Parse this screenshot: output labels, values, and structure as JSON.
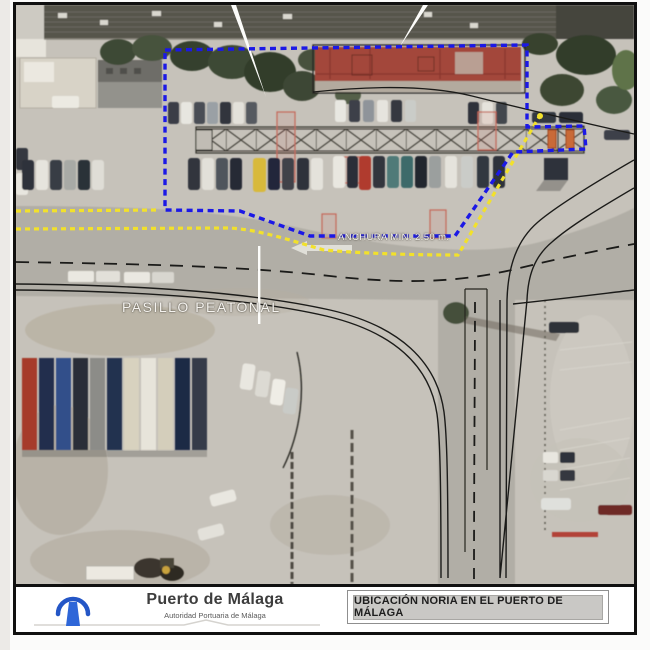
{
  "map": {
    "labels": {
      "pasillo": "PASILLO PEATONAL",
      "anchura": "ANCHURA MIN. 2.50 m."
    },
    "colors": {
      "site_boundary": "#1b18e6",
      "pedestrian_path": "#f2e12b"
    }
  },
  "footer": {
    "org_name": "Puerto de Málaga",
    "org_subtitle": "Autoridad Portuaria de Málaga",
    "drawing_title": "UBICACIÓN NORIA EN EL PUERTO DE MÁLAGA",
    "logo_icon": "lighthouse-arch-icon"
  }
}
